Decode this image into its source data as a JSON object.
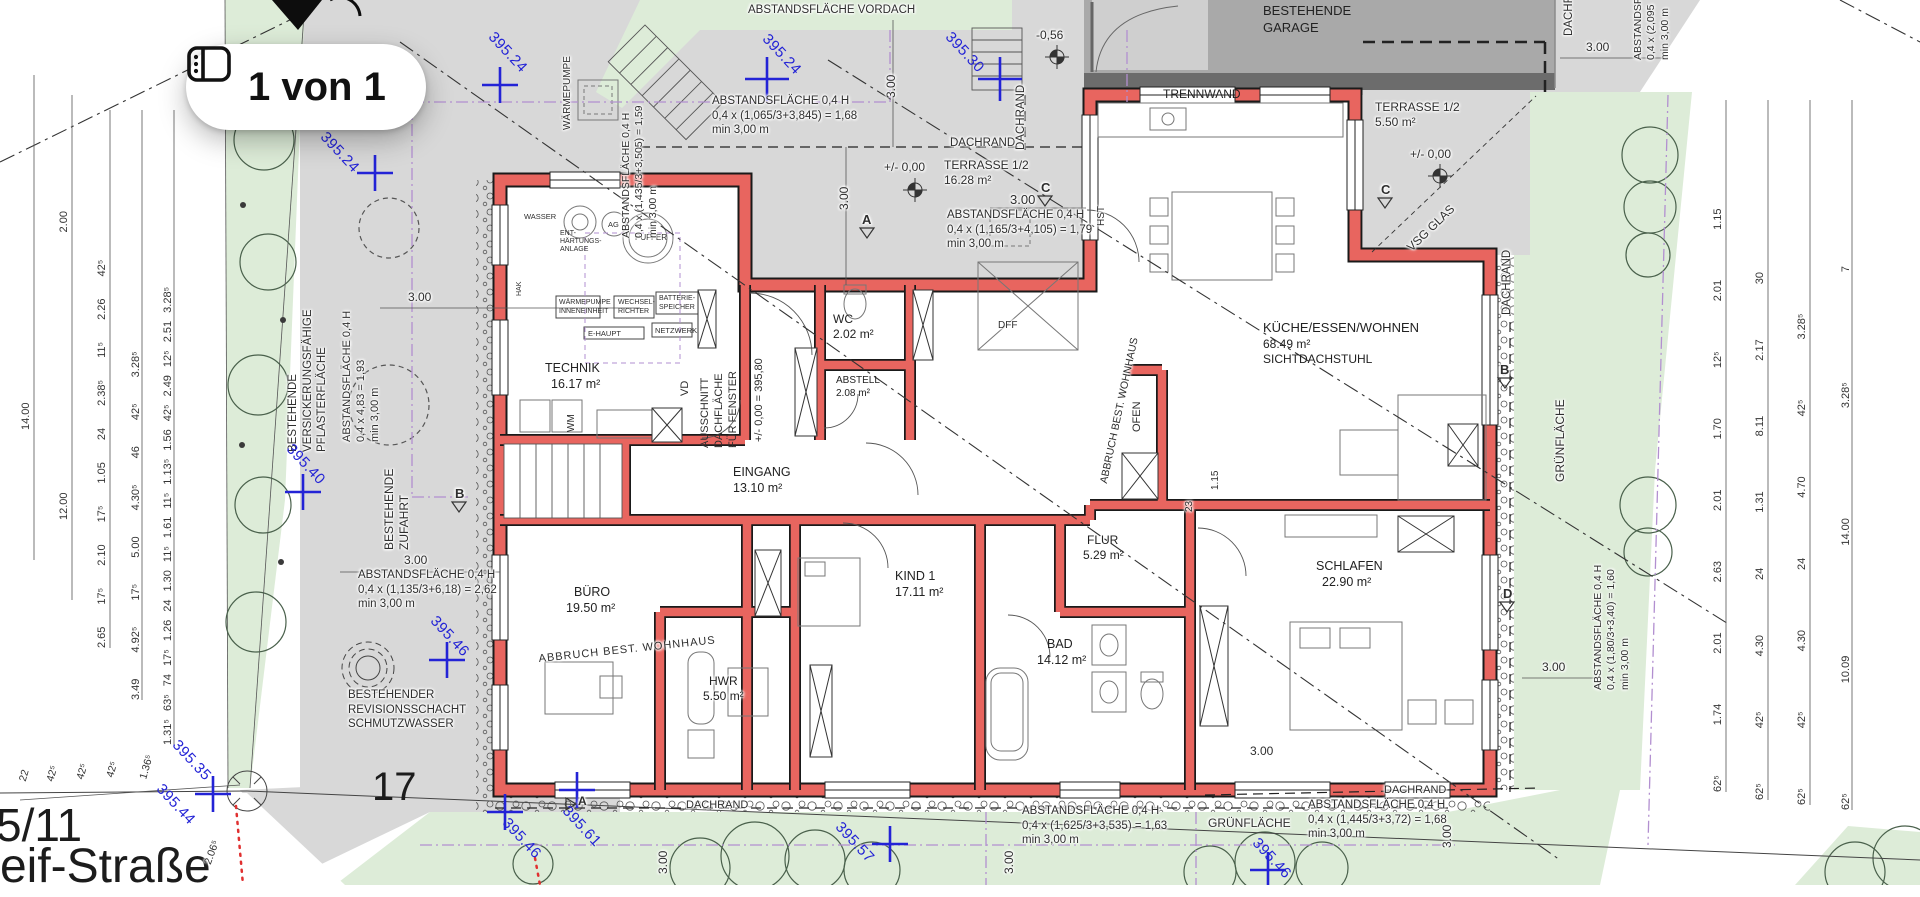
{
  "viewer": {
    "page_indicator": "1 von 1"
  },
  "parcel": {
    "lot": "17",
    "neighbor_lot": "5/11",
    "street": "reif-Straße"
  },
  "rooms": {
    "technik": {
      "name": "TECHNIK",
      "area": "16.17 m²"
    },
    "wc": {
      "name": "WC",
      "area": "2.02 m²"
    },
    "abstell": {
      "name": "ABSTELL",
      "area": "2.08 m²"
    },
    "eingang": {
      "name": "EINGANG",
      "area": "13.10 m²"
    },
    "buero": {
      "name": "BÜRO",
      "area": "19.50 m²"
    },
    "kind1": {
      "name": "KIND 1",
      "area": "17.11 m²"
    },
    "hwr": {
      "name": "HWR",
      "area": "5.50 m²"
    },
    "flur": {
      "name": "FLUR",
      "area": "5.29 m²"
    },
    "bad": {
      "name": "BAD",
      "area": "14.12 m²"
    },
    "schlafen": {
      "name": "SCHLAFEN",
      "area": "22.90 m²"
    },
    "kueche": {
      "name": "KÜCHE/ESSEN/WOHNEN",
      "area": "68.49 m²",
      "note": "SICHTDACHSTUHL"
    },
    "terrasse_w": {
      "name": "TERRASSE 1/2",
      "area": "16.28 m²"
    },
    "terrasse_o": {
      "name": "TERRASSE 1/2",
      "area": "5.50 m²"
    }
  },
  "levels": {
    "zero": "+/- 0,00",
    "zero_abs": "+/- 0,00 = 395,80",
    "garage_level": "-0,56"
  },
  "site": {
    "vordach": "ABSTANDSFLÄCHE VORDACH",
    "garage": [
      "BESTEHENDE",
      "GARAGE"
    ],
    "trennwand": "TRENNWAND",
    "dachrand": "DACHRAND",
    "gruen": "GRÜNFLÄCHE",
    "pflaster": [
      "BESTEHENDE",
      "VERSICKERUNGSFÄHIGE",
      "PFLASTERFLÄCHE"
    ],
    "zufahrt": [
      "BESTEHENDE",
      "ZUFAHRT"
    ],
    "revision": [
      "BESTEHENDER",
      "REVISIONSSCHACHT",
      "SCHMUTZWASSER"
    ],
    "abbruch": "ABBRUCH BEST. WOHNHAUS",
    "vsg": "VSG GLAS",
    "wp_aussen": "WÄRMEPUMPE"
  },
  "abstand": {
    "a1": [
      "ABSTANDSFLÄCHE 0,4 H",
      "0,4 x (1,065/3+3,845) = 1,68",
      "min 3,00 m"
    ],
    "a2": [
      "ABSTANDSFLÄCHE 0,4 H",
      "0,4 x (1,165/3+4,105) = 1,79",
      "min 3,00 m"
    ],
    "a3": [
      "ABSTANDSFLÄCHE 0,4 H",
      "0,4 x (1,435/3+3,505) = 1,59",
      "min 3,00 m"
    ],
    "a4": [
      "ABSTANDSFLÄCHE 0,4 H",
      "0,4 x 4,83 = 1,93",
      "min 3,00 m"
    ],
    "a5": [
      "ABSTANDSFLÄCHE 0,4 H",
      "0,4 x (1,135/3+6,18) = 2,62",
      "min 3,00 m"
    ],
    "a6": [
      "ABSTANDSFLÄCHE 0,4 H",
      "0,4 x (1,625/3+3,535) = 1,63",
      "min 3,00 m"
    ],
    "a7": [
      "ABSTANDSFLÄCHE 0,4 H",
      "0,4 x (1,445/3+3,72) = 1,68",
      "min 3,00 m"
    ],
    "a8": [
      "ABSTANDSFLÄCHE 0,4 H",
      "0,4 x (1,80/3+3,40) = 1,60",
      "min 3,00 m"
    ],
    "a9": [
      "ABSTANDSFLÄCHE",
      "0,4 x (2,095",
      "min 3,00 m"
    ]
  },
  "tech": {
    "wasser": "WASSER",
    "enth": [
      "ENT-",
      "HÄRTUNGS-",
      "ANLAGE"
    ],
    "ag": "AG",
    "puffer": "PUFFER",
    "wp": [
      "WÄRMEPUMPE",
      "INNENEINHEIT"
    ],
    "wr": [
      "WECHSEL-",
      "RICHTER"
    ],
    "bs": [
      "BATTERIE-",
      "SPEICHER"
    ],
    "nw": "NETZWERK",
    "eh": "E-HAUPT",
    "wm": "WM",
    "hak": "HAK",
    "vd": "VD",
    "ausschnitt": [
      "AUSSCHNITT",
      "DACHFLÄCHE",
      "FÜR FENSTER"
    ],
    "hst": "HST",
    "dff": "DFF",
    "ofen": "OFEN"
  },
  "markers": {
    "a": "A",
    "b": "B",
    "c": "C",
    "d": "D"
  },
  "elev": [
    "395.24",
    "395.24",
    "395.30",
    "395.24",
    "395.40",
    "395.46",
    "395.35",
    "395.44",
    "395.46",
    "395.61",
    "395.57",
    "395.46"
  ],
  "dims": {
    "inline": {
      "d300": "3.00",
      "d23": "23",
      "d115": "1.15",
      "d206": "2.06⁵"
    },
    "left": {
      "c1": [
        "14.00"
      ],
      "c2": [
        "2.00",
        "12.00"
      ],
      "c3": [
        "42⁵",
        "2.26",
        "11⁵",
        "2.38⁵",
        "24",
        "1.05",
        "17⁵",
        "2.10",
        "17⁵",
        "2.65"
      ],
      "c4": [
        "3.28⁵",
        "42⁵",
        "46",
        "4.30⁵",
        "5.00",
        "17⁵",
        "4.92⁵",
        "3.49"
      ],
      "c5": [
        "3.28⁵",
        "2.51",
        "12⁵",
        "2.49",
        "42⁵",
        "1.56",
        "1.13⁵",
        "11⁵",
        "1.61",
        "11⁵",
        "1.30",
        "24",
        "1.26",
        "17⁵",
        "74",
        "63⁵",
        "1.31⁵"
      ]
    },
    "right": {
      "c1": [
        "1.15",
        "2.01",
        "12⁵",
        "1.70",
        "2.01",
        "2.63",
        "2.01",
        "1.74",
        "62⁵"
      ],
      "c2": [
        "30",
        "2.17",
        "8.11",
        "1.31",
        "24",
        "4.30",
        "42⁵",
        "62⁵"
      ],
      "c3": [
        "3.28⁵",
        "42⁵",
        "4.70",
        "24",
        "4.30",
        "42⁵",
        "62⁵"
      ],
      "c4": [
        "7",
        "3.28⁵",
        "14.00",
        "10.09",
        "62⁵"
      ]
    },
    "boundary": [
      "22",
      "42⁵",
      "42⁵",
      "42⁵",
      "1.36⁵"
    ]
  },
  "colors": {
    "wall": "#e8655f",
    "green": "#ddecd8",
    "paving": "#d8d8d8",
    "garage": "#a9a9a9",
    "blue": "#2323d6",
    "purple": "#b28fd0"
  }
}
